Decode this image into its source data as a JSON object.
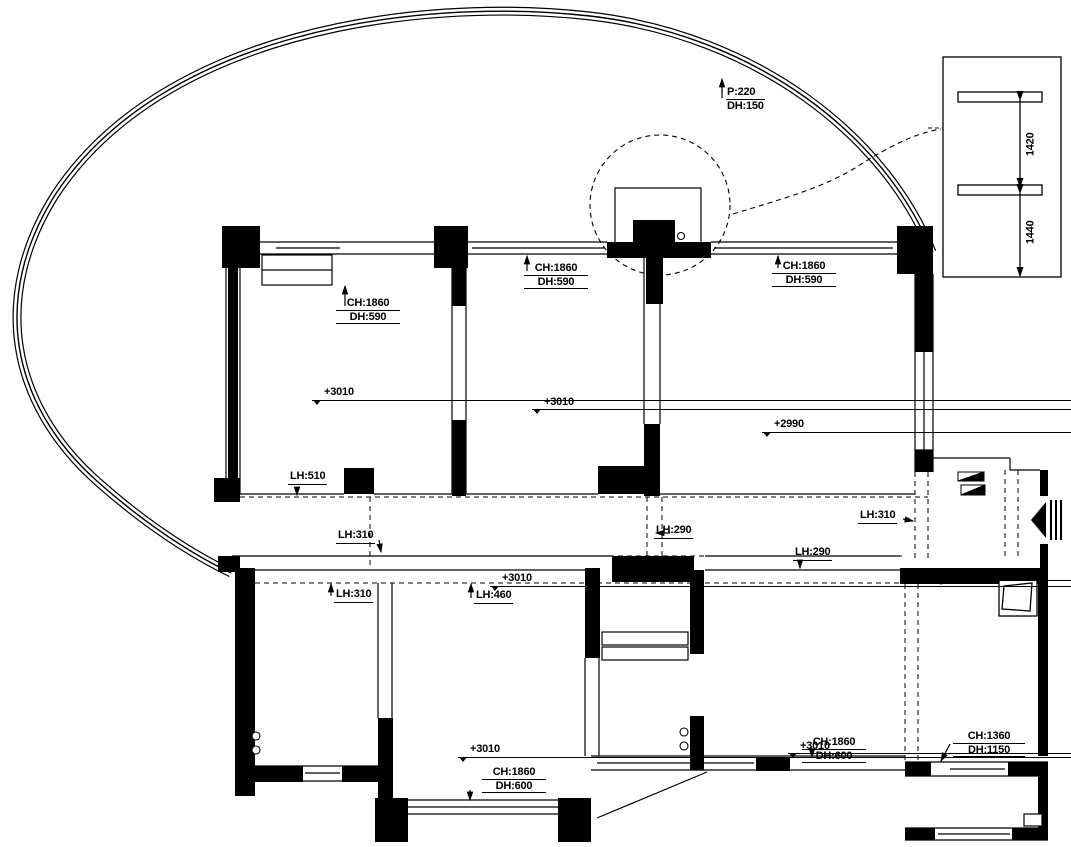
{
  "plan": {
    "colors": {
      "line": "#000000",
      "background": "#ffffff"
    },
    "curve_label": {
      "line1": "P:220",
      "line2": "DH:150"
    },
    "detail_dims": [
      {
        "text": "1420"
      },
      {
        "text": "1440"
      }
    ],
    "window_labels": [
      {
        "ch": "CH:1860",
        "dh": "DH:590"
      },
      {
        "ch": "CH:1860",
        "dh": "DH:590"
      },
      {
        "ch": "CH:1860",
        "dh": "DH:590"
      },
      {
        "ch": "CH:1860",
        "dh": "DH:600"
      },
      {
        "ch": "CH:1860",
        "dh": "DH:600"
      },
      {
        "ch": "CH:1360",
        "dh": "DH:1150"
      }
    ],
    "level_labels": [
      {
        "text": "+3010"
      },
      {
        "text": "+3010"
      },
      {
        "text": "+2990"
      },
      {
        "text": "+3010"
      },
      {
        "text": "+2990"
      },
      {
        "text": "+3010"
      },
      {
        "text": "+3010"
      }
    ],
    "lh_labels": [
      {
        "text": "LH:510"
      },
      {
        "text": "LH:310"
      },
      {
        "text": "LH:290"
      },
      {
        "text": "LH:310"
      },
      {
        "text": "LH:290"
      },
      {
        "text": "LH:310"
      },
      {
        "text": "LH:460"
      }
    ]
  }
}
